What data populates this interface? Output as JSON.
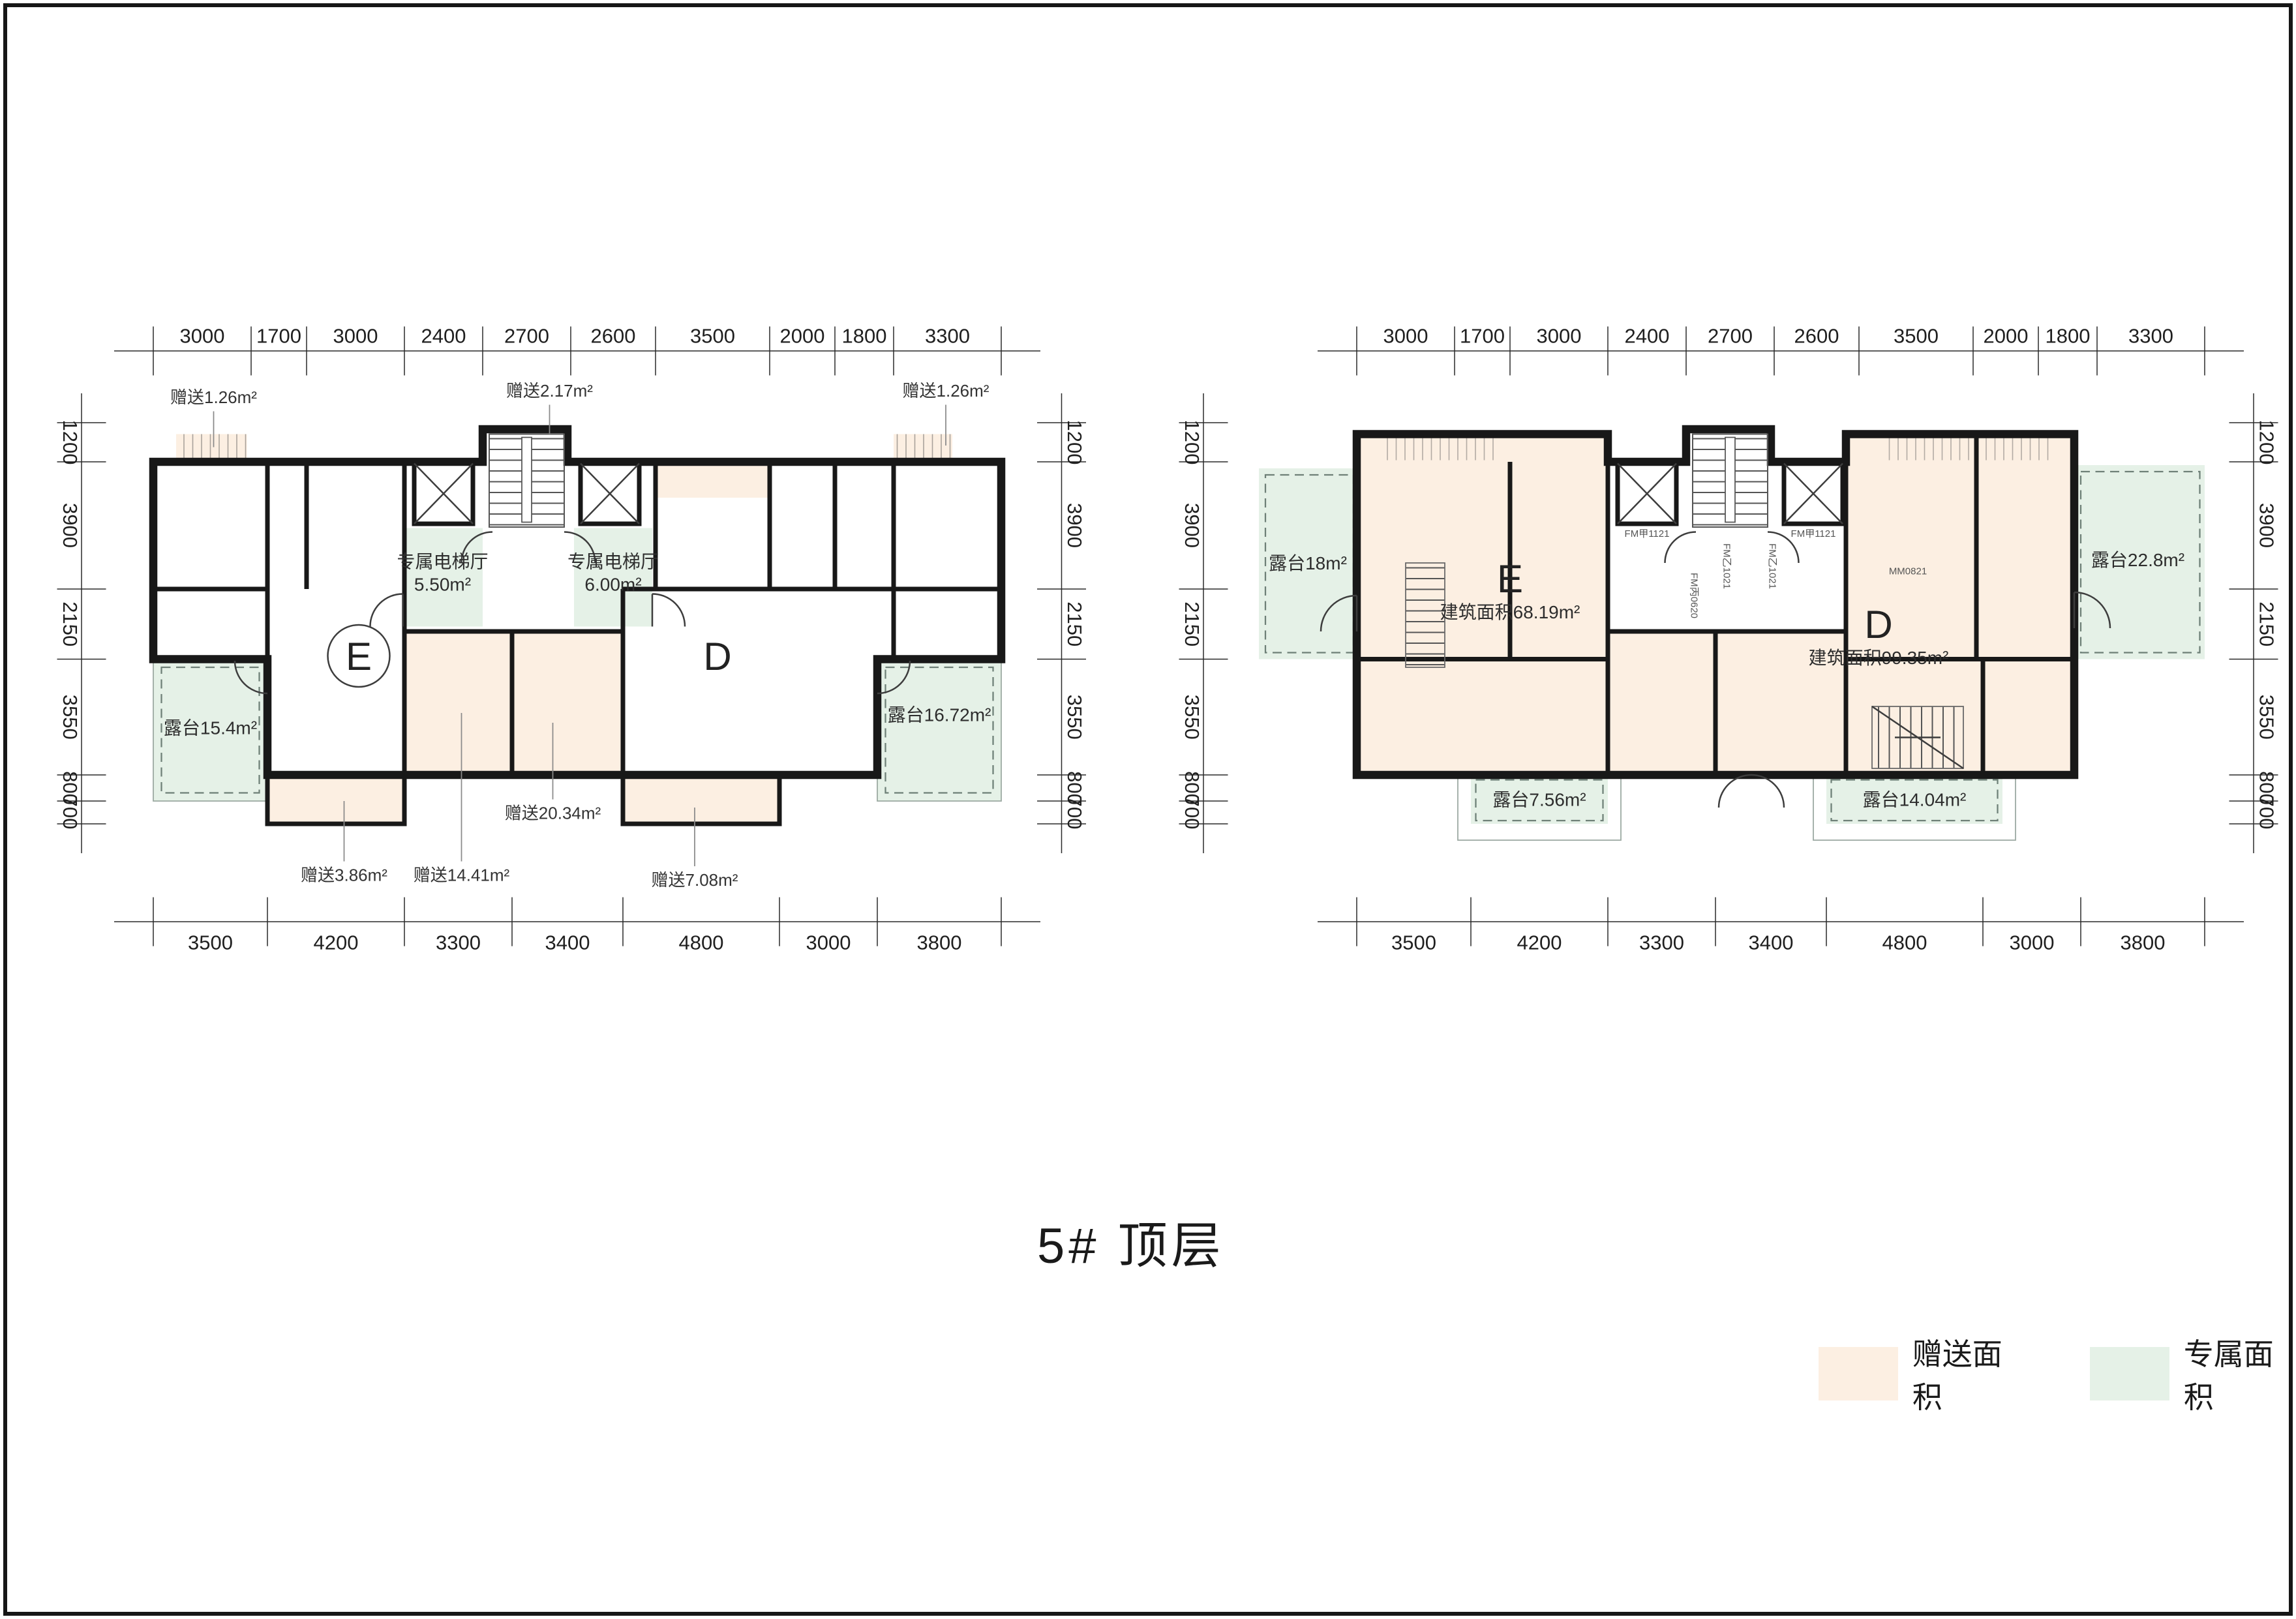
{
  "title": "5# 顶层",
  "legend": {
    "gift": "赠送面积",
    "exclusive": "专属面积"
  },
  "colors": {
    "gift": "#fcefe2",
    "exclusive": "#e5f1e7",
    "wall": "#181818"
  },
  "dims": {
    "top": [
      "3000",
      "1700",
      "3000",
      "2400",
      "2700",
      "2600",
      "3500",
      "2000",
      "1800",
      "3300"
    ],
    "bottom": [
      "3500",
      "4200",
      "3300",
      "3400",
      "4800",
      "3000",
      "3800"
    ],
    "side": [
      "1200",
      "3900",
      "2150",
      "3550",
      "800",
      "700"
    ]
  },
  "left": {
    "unit_e": "E",
    "unit_d": "D",
    "gift_tl": "赠送1.26m²",
    "gift_top": "赠送2.17m²",
    "gift_tr": "赠送1.26m²",
    "hall_e_name": "专属电梯厅",
    "hall_e_area": "5.50m²",
    "hall_d_name": "专属电梯厅",
    "hall_d_area": "6.00m²",
    "terrace_l": "露台15.4m²",
    "terrace_r": "露台16.72m²",
    "gift_bed1": "赠送14.41m²",
    "gift_bed2": "赠送20.34m²",
    "gift_bay1": "赠送3.86m²",
    "gift_bay2": "赠送7.08m²"
  },
  "right": {
    "unit_e": "E",
    "unit_e_area": "建筑面积68.19m²",
    "unit_d": "D",
    "unit_d_area": "建筑面积99.35m²",
    "terrace_l": "露台18m²",
    "terrace_r": "露台22.8m²",
    "terrace_bl": "露台7.56m²",
    "terrace_br": "露台14.04m²",
    "door_elev_l": "FM甲1121",
    "door_elev_r": "FM甲1121",
    "door_lobby_l": "FM乙1021",
    "door_lobby_r": "FM乙1021",
    "door_front": "FM丙0620",
    "door_mm": "MM0821"
  }
}
